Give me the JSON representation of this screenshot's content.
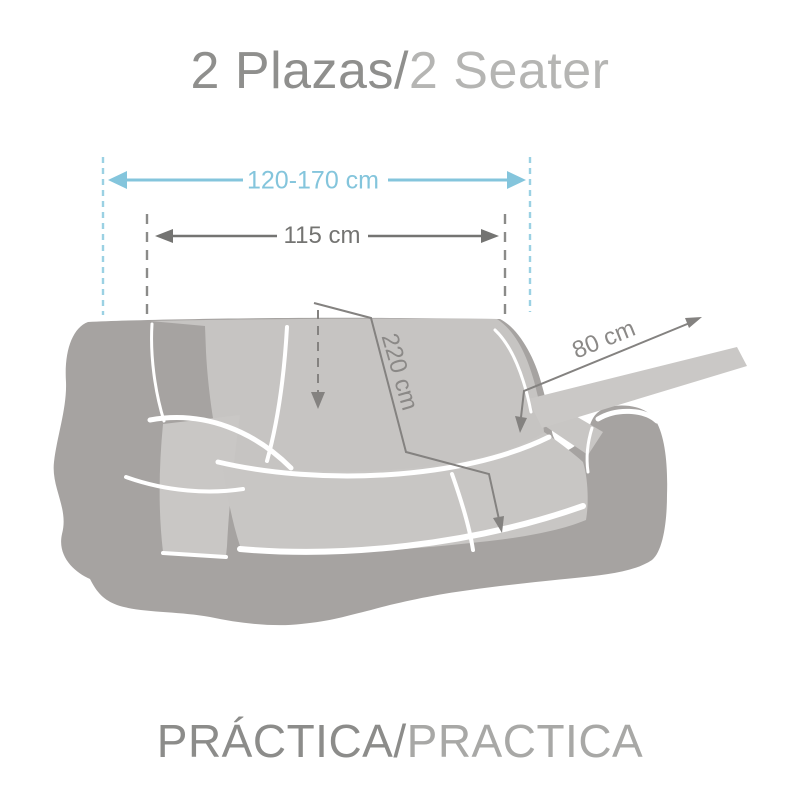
{
  "header": {
    "title_primary": "2 Plazas/",
    "title_secondary": "2 Seater"
  },
  "footer": {
    "label_primary": "PRÁCTICA/",
    "label_secondary": "PRACTICA"
  },
  "diagram": {
    "cover_width_label": "120-170 cm",
    "sofa_width_label": "115 cm",
    "cover_length_label": "220 cm",
    "strap_length_label": "80 cm"
  },
  "colors": {
    "accent_blue": "#84c5dc",
    "accent_blue_dashed": "#9bd1e3",
    "dimension_gray": "#747472",
    "measure_line_gray": "#848280",
    "sofa_body_gray": "#a6a3a1",
    "sofa_cover_gray": "#c7c5c3",
    "highlight_white": "#ffffff",
    "title_dark_gray": "#8f8f8d",
    "title_light_gray": "#b5b5b3"
  }
}
